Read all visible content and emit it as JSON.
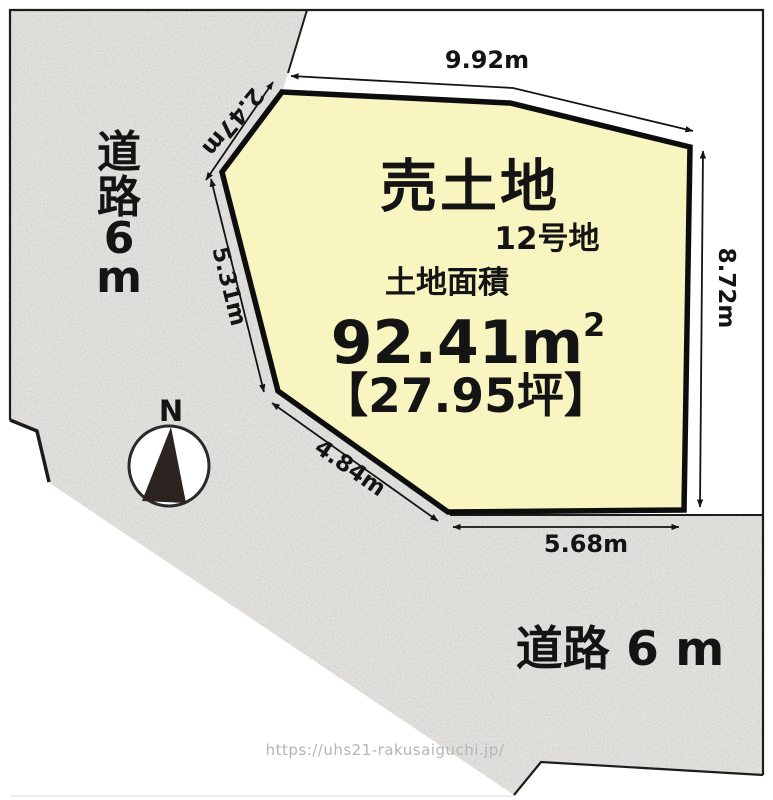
{
  "parcel": {
    "title": "売土地",
    "lot_number": "12号地",
    "area_label": "土地面積",
    "area_value": "92.41m",
    "area_sup": "2",
    "area_tsubo": "【27.95坪】"
  },
  "dimensions": {
    "top": "9.92m",
    "upper_left": "2.47m",
    "left": "5.31m",
    "lower_left": "4.84m",
    "bottom": "5.68m",
    "right": "8.72m"
  },
  "roads": {
    "left_chars": [
      "道",
      "路",
      "6",
      "m"
    ],
    "bottom": "道路 6 m"
  },
  "compass": {
    "label": "N"
  },
  "watermark": "https://uhs21-rakusaiguchi.jp/",
  "colors": {
    "parcel_fill": "#f8f5c1",
    "road_fill": "#ebeae6",
    "line": "#141414"
  }
}
